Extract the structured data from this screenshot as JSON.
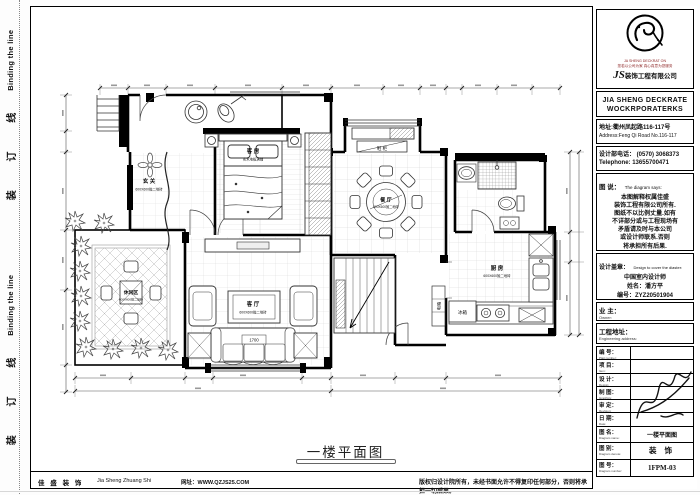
{
  "binding": {
    "cn": "装 订 线",
    "en": "Binding the line"
  },
  "plan": {
    "title": "一楼平面图",
    "rooms": {
      "entry": {
        "name": "玄 关",
        "floor": "600X600抛二地砖"
      },
      "guest": {
        "name": "客 房",
        "floor": "实木地板满铺"
      },
      "dining": {
        "name": "餐 厅",
        "floor": "600X600抛二地砖"
      },
      "living": {
        "name": "客 厅",
        "floor": "600X600抛二地砖"
      },
      "kitchen": {
        "name": "厨 房",
        "floor": "600X600抛二地砖"
      },
      "leisure": {
        "name": "休闲区",
        "floor": "600X600抛二地砖"
      }
    },
    "labels": {
      "fridge": "冰箱",
      "shoe_cabinet": "鞋 柜",
      "sofa_dim": "1700",
      "power_box": "电箱"
    }
  },
  "titleblock": {
    "logo": {
      "tiny_red_1": "JA SHENG DECKRAT ON",
      "tiny_red_2": "您若以公司为家 真心真意为您服务",
      "company_js": "JS",
      "company_cn": "装饰工程有限公司",
      "company_en_1": "JIA SHENG DECKRATE",
      "company_en_2": "WOCKRPORATERKS"
    },
    "address": {
      "cn": "地址:衢州凤起路116-117号",
      "en": "Address:Feng Qi Road No.116-117"
    },
    "phone": {
      "cn": "设计部电话： (0570) 3068373",
      "en": "Telephone: 13655700471"
    },
    "notice": {
      "cn": "图 说：",
      "en": "The diagram says:",
      "lines": [
        "本图解释权属佳盛",
        "装饰工程有限公司所有.",
        "图纸不以比例丈量.如有",
        "不详部分或与工程现场有",
        "矛盾请及时与本公司",
        "或设计师联系.否则",
        "将承担所有后果."
      ]
    },
    "stamp": {
      "cn": "设计盖章：",
      "en": "Design to cover the diaster:",
      "cert": "中国室内设计师",
      "name": "姓名：潘方平",
      "number": "编号：ZYZ20501904"
    },
    "owner": {
      "cn": "业 主：",
      "en": "Owner:"
    },
    "site": {
      "cn": "工程地址：",
      "en": "Engineering address:"
    },
    "rows": [
      {
        "cn": "编 号：",
        "en": "Plait number:",
        "value": ""
      },
      {
        "cn": "项 目：",
        "en": "Item:",
        "value": ""
      },
      {
        "cn": "设 计：",
        "en": "Design:",
        "value": ""
      },
      {
        "cn": "制 图：",
        "en": "Graphics:",
        "value": ""
      },
      {
        "cn": "审 定：",
        "en": "Revision:",
        "value": ""
      },
      {
        "cn": "日 期：",
        "en": "Date:",
        "value": ""
      },
      {
        "cn": "图 名：",
        "en": "Diagram name:",
        "value": "一楼平面图"
      },
      {
        "cn": "图 别：",
        "en": "Diagram denote:",
        "value": "装 饰"
      },
      {
        "cn": "图 号：",
        "en": "Diagram number:",
        "value": "1FPM-03"
      }
    ]
  },
  "footer": {
    "brand": "佳 盛 装 饰",
    "pinyin": "Jia Sheng Zhuang Shi",
    "url": "网址：WWW.QZJS25.COM",
    "copyright": "版权归设计院所有，未经书面允许不得复印任何部分，否则将承担一切后果。"
  }
}
